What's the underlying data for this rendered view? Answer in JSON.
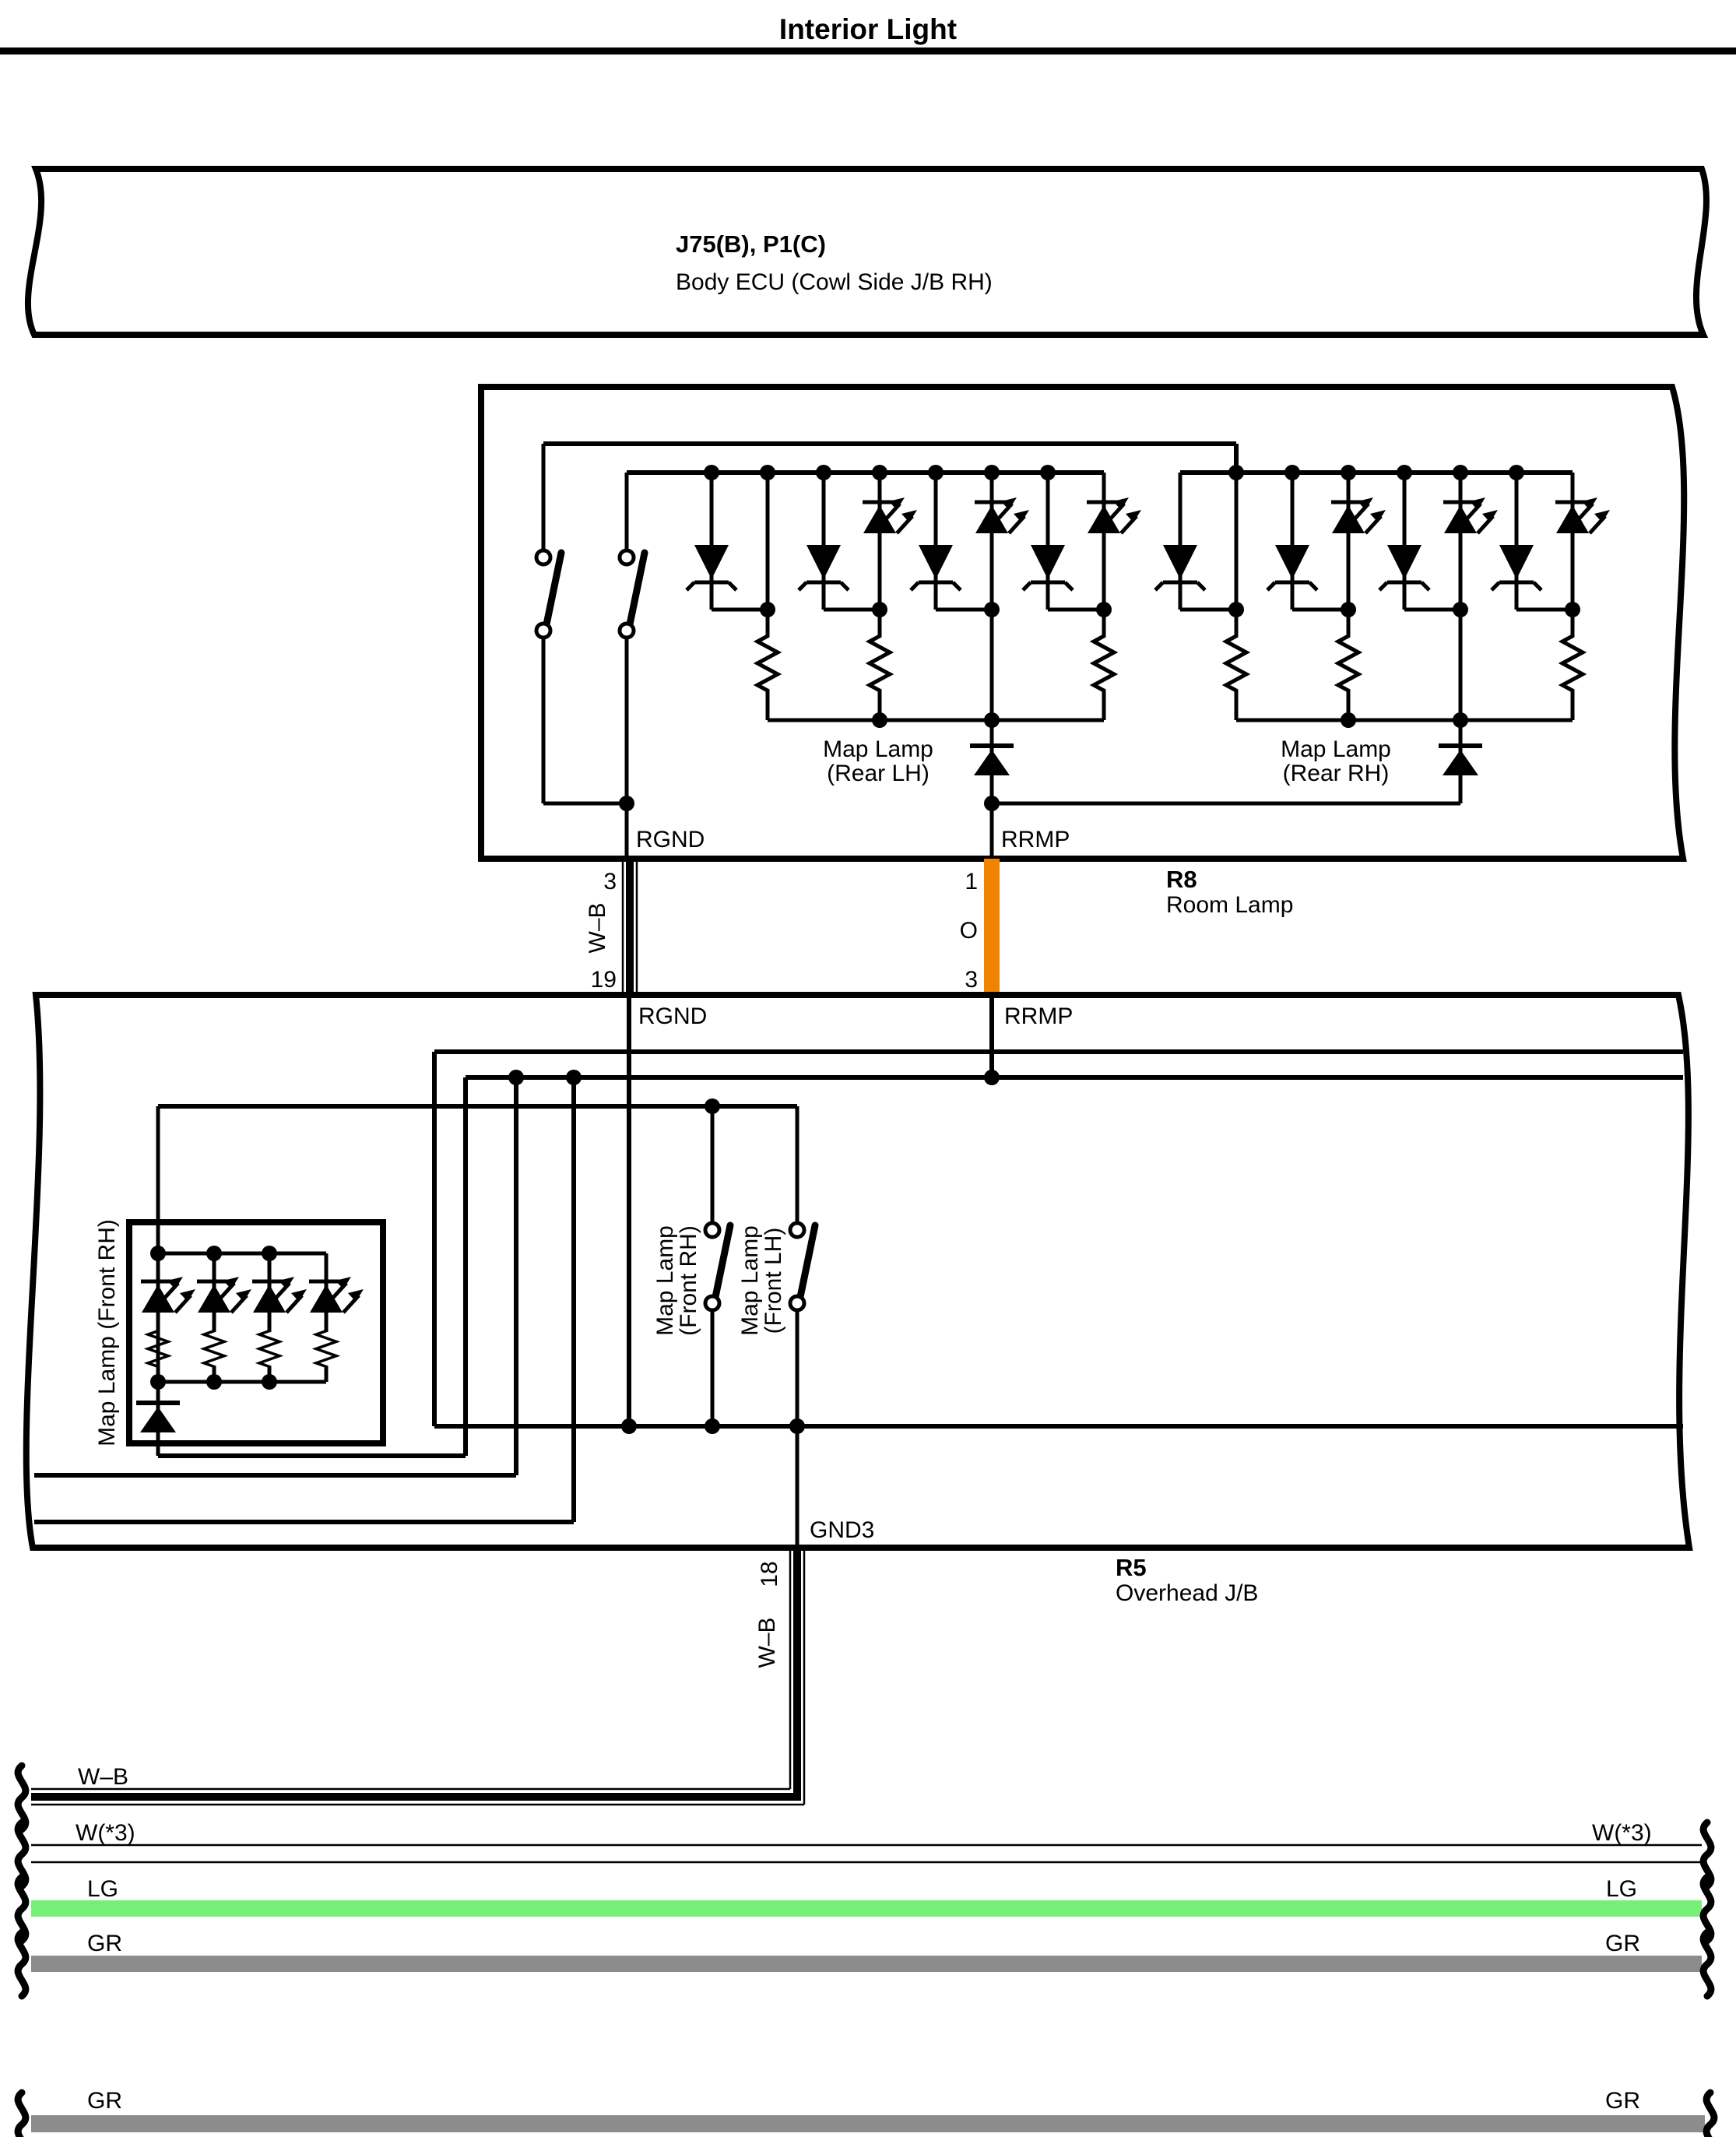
{
  "page": {
    "title": "Interior Light"
  },
  "colors": {
    "box_fill": "#CFF7F8",
    "wire_orange": "#F08300",
    "wire_light_green": "#77EE77",
    "wire_gray": "#8C8C8C",
    "line_black": "#000000"
  },
  "body_ecu": {
    "code": "J75(B), P1(C)",
    "name": "Body ECU (Cowl Side J/B RH)"
  },
  "room_lamp": {
    "code": "R8",
    "name": "Room Lamp",
    "pin_rgnd": "RGND",
    "pin_rrmp": "RRMP",
    "map_lamp_rear_lh": [
      "Map Lamp",
      "(Rear LH)"
    ],
    "map_lamp_rear_rh": [
      "Map Lamp",
      "(Rear RH)"
    ]
  },
  "overhead_jb": {
    "code": "R5",
    "name": "Overhead J/B",
    "pin_rgnd": "RGND",
    "pin_rrmp": "RRMP",
    "pin_gnd3": "GND3",
    "map_lamp_front_rh_unit": "Map Lamp (Front RH)",
    "switch_front_rh": [
      "Map Lamp",
      "(Front RH)"
    ],
    "switch_front_lh": [
      "Map Lamp",
      "(Front LH)"
    ]
  },
  "wires": {
    "rgnd": {
      "pin_top": "3",
      "color_label": "W–B",
      "pin_bottom": "19"
    },
    "rrmp": {
      "pin_top": "1",
      "color_label": "O",
      "pin_bottom": "3"
    },
    "gnd3": {
      "pin_top": "18",
      "color_label": "W–B"
    }
  },
  "bottom_wires": [
    {
      "id": "wb",
      "label_left": "W–B"
    },
    {
      "id": "w3",
      "label_left": "W(*3)",
      "label_right": "W(*3)"
    },
    {
      "id": "lg",
      "label_left": "LG",
      "label_right": "LG"
    },
    {
      "id": "gr",
      "label_left": "GR",
      "label_right": "GR"
    },
    {
      "id": "gr2",
      "label_left": "GR",
      "label_right": "GR"
    }
  ]
}
